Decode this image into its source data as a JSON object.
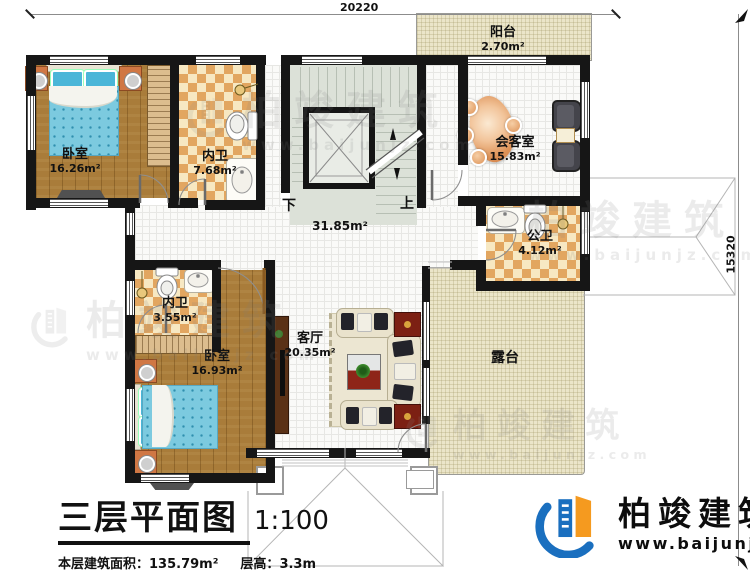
{
  "dimensions": {
    "top_width": "20220",
    "right_height": "15320"
  },
  "hall": {
    "area": "31.85m²"
  },
  "stairs": {
    "down_label": "下",
    "up_label": "上"
  },
  "rooms": {
    "balcony": {
      "name": "阳台",
      "area": "2.70m²"
    },
    "bedroom1": {
      "name": "卧室",
      "area": "16.26m²"
    },
    "bath1": {
      "name": "内卫",
      "area": "7.68m²"
    },
    "reception": {
      "name": "会客室",
      "area": "15.83m²"
    },
    "public_bath": {
      "name": "公卫",
      "area": "4.12m²"
    },
    "bath2": {
      "name": "内卫",
      "area": "3.55m²"
    },
    "bedroom2": {
      "name": "卧室",
      "area": "16.93m²"
    },
    "living": {
      "name": "客厅",
      "area": "20.35m²"
    },
    "terrace": {
      "name": "露台"
    }
  },
  "title_block": {
    "title": "三层平面图",
    "scale": "1:100",
    "floor_area_label": "本层建筑面积：",
    "floor_area_value": "135.79m²",
    "story_height_label": "层高：",
    "story_height_value": "3.3m"
  },
  "brand": {
    "company": "柏竣建筑",
    "website": "www.baijunjz.com"
  },
  "watermark": {
    "company": "柏竣建筑",
    "website": "www.baijunjz.com"
  },
  "colors": {
    "wall": "#161616",
    "wood_floor": "#a97c3a",
    "tile_checker": "#e2a660",
    "terrace_floor": "#ebe5c9",
    "stair_floor": "#dce1d8",
    "bed_blue": "#7ccadf",
    "logo_blue": "#1a6fbf",
    "logo_orange": "#f59a1f"
  }
}
